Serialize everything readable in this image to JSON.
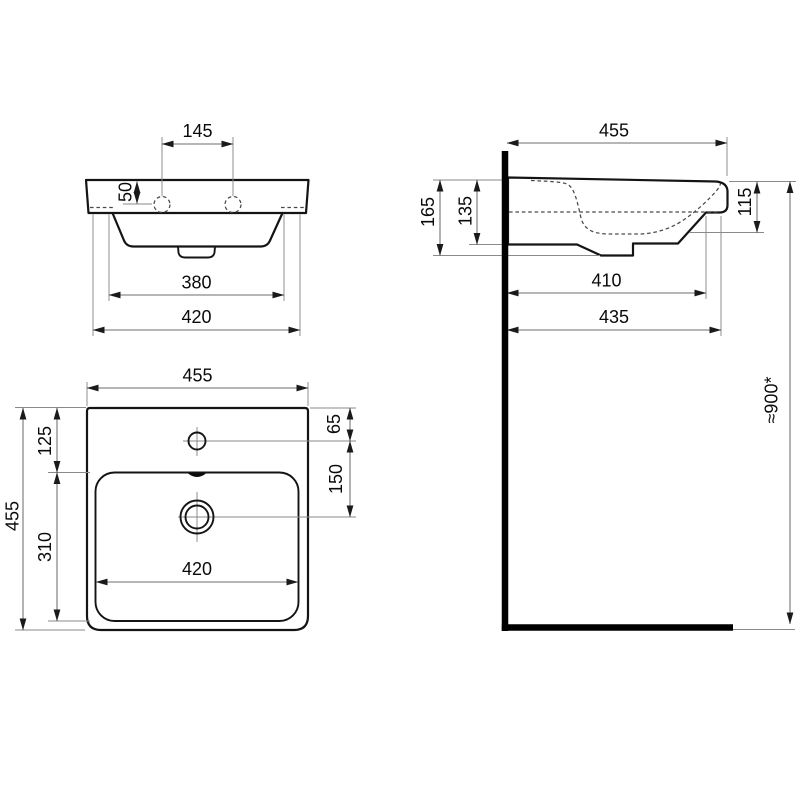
{
  "colors": {
    "line": "#141414",
    "dimension_line": "#6e6e6e",
    "hidden_line": "#4a4a4a",
    "wall": "#000000",
    "background": "#ffffff"
  },
  "front_view": {
    "tap_hole_spacing": "145",
    "tap_hole_offset": "50",
    "outlet_width": "380",
    "base_width": "420"
  },
  "side_view": {
    "depth": "455",
    "overall_height": "165",
    "basin_height": "135",
    "front_edge_height": "115",
    "underside_depth": "410",
    "lower_edge_depth": "435",
    "mounting_height": "≈900*"
  },
  "plan_view": {
    "overall_width": "455",
    "overall_depth": "455",
    "back_to_bowl": "125",
    "bowl_depth": "310",
    "back_to_tap": "65",
    "tap_to_drain": "150",
    "bowl_width": "420"
  }
}
